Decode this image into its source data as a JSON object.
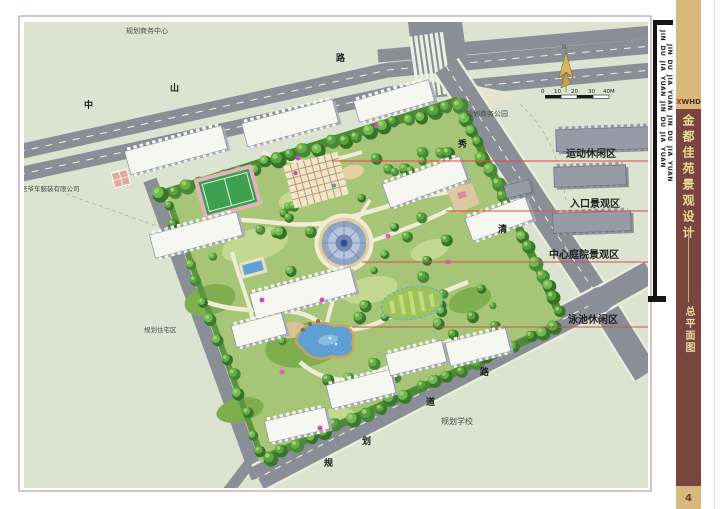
{
  "colors": {
    "maroon": "#7a453f",
    "tan": "#d7b97b",
    "tan_text": "#ead9a0",
    "leader_red": "#e04848",
    "page_border": "#bb8585",
    "logo_x_red": "#cc2200"
  },
  "plan": {
    "area_labels": [
      {
        "text": "运动休闲区"
      },
      {
        "text": "入口景观区"
      },
      {
        "text": "中心庭院景观区"
      },
      {
        "text": "泳池休闲区"
      }
    ],
    "context_labels": {
      "business_center": "规划商务中心",
      "business_park": "规划商务公园",
      "company": "老爷车服装有限公司",
      "residential": "规划住宅区",
      "school": "规划学校"
    },
    "road_chars": {
      "top": [
        "中",
        "山",
        "路"
      ],
      "east": [
        "秀",
        "清"
      ],
      "bottom": [
        "规",
        "划",
        "道",
        "路"
      ]
    },
    "north_label": "N",
    "scale_ticks": [
      "0",
      "10",
      "20",
      "30",
      "40M"
    ]
  },
  "sidebar": {
    "jin_text": "JIN DU JIA YUAN JIN DU JIA YUAN",
    "logo_x": "X",
    "logo_rest": "WHD",
    "title": "金都佳苑景观设计",
    "subtitle": "总平面图",
    "page_number": "4"
  }
}
